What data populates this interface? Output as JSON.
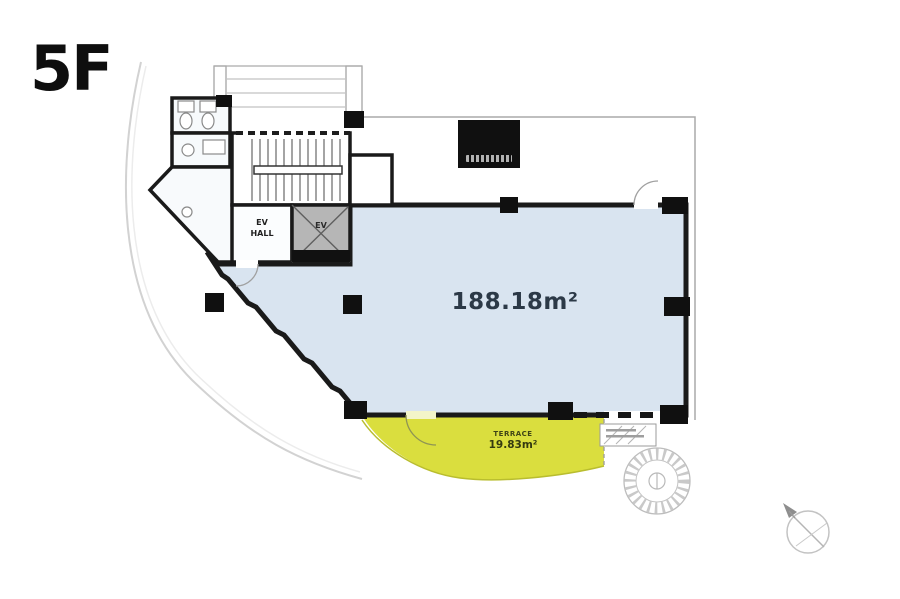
{
  "floor": {
    "label": "5F"
  },
  "main_room": {
    "area_label": "188.18m²"
  },
  "terrace": {
    "label": "TERRACE",
    "area_label": "19.83m²"
  },
  "elevator": {
    "label": "EV"
  },
  "elevator_hall": {
    "label_line1": "EV",
    "label_line2": "HALL"
  },
  "colors": {
    "main_room_fill": "#d9e4f0",
    "terrace_fill": "#dade3e",
    "elevator_fill": "#b6b6b6",
    "wall": "#1a1a1a",
    "thin_line": "#9b9b9b",
    "area_text": "#2c3947",
    "terrace_text": "#3f4416"
  }
}
